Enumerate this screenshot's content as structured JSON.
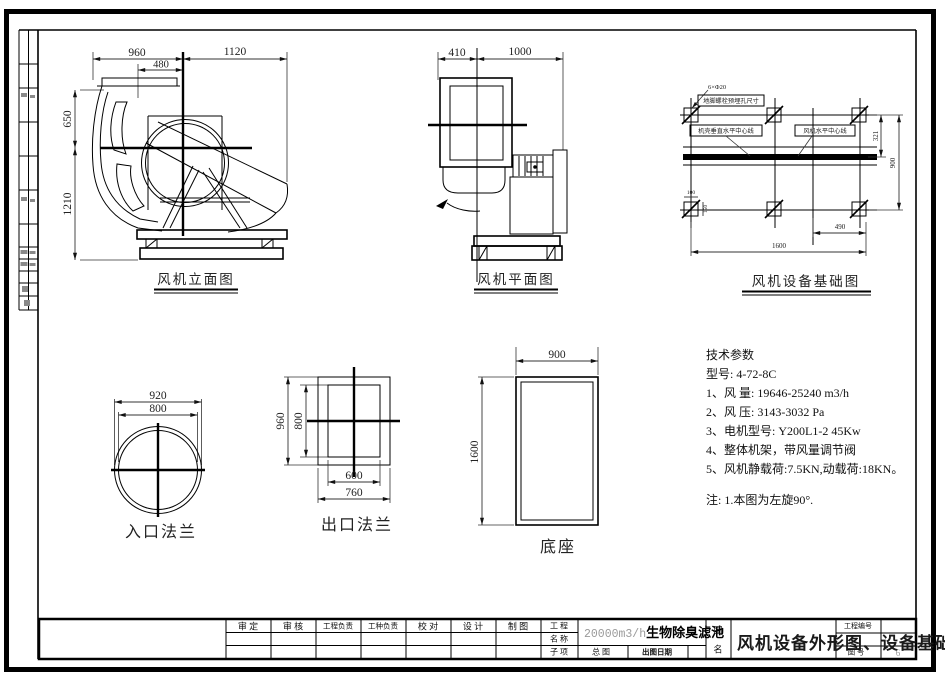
{
  "drawing": {
    "views": {
      "elevation": {
        "label": "风机立面图",
        "dim_960": "960",
        "dim_1120": "1120",
        "dim_480": "480",
        "dim_650": "650",
        "dim_1210": "1210"
      },
      "plan": {
        "label": "风机平面图",
        "dim_410": "410",
        "dim_1000": "1000"
      },
      "foundation": {
        "label": "风机设备基础图",
        "callout_bolts": "6×Φ20",
        "callout_holes": "地脚螺栓预埋孔尺寸",
        "callout_casing_cl": "机壳垂直水平中心线",
        "callout_fan_cl": "风机水平中心线",
        "dim_321": "321",
        "dim_900": "900",
        "dim_490": "490",
        "dim_1600": "1600",
        "dim_100": "100",
        "dim_150": "150"
      },
      "inlet_flange": {
        "label": "入口法兰",
        "dim_920": "920",
        "dim_800": "800"
      },
      "outlet_flange": {
        "label": "出口法兰",
        "dim_960": "960",
        "dim_800": "800",
        "dim_600": "600",
        "dim_760": "760"
      },
      "base": {
        "label": "底座",
        "dim_900": "900",
        "dim_1600": "1600"
      }
    },
    "tech_params": {
      "title": "技术参数",
      "model": "型号: 4-72-8C",
      "items": [
        "1、风    量: 19646-25240 m3/h",
        "2、风    压: 3143-3032 Pa",
        "3、电机型号: Y200L1-2 45Kw",
        "4、整体机架，带风量调节阀",
        "5、风机静载荷:7.5KN,动载荷:18KN。"
      ],
      "note": "注: 1.本图为左旋90°."
    },
    "title_block": {
      "sign_labels": [
        "审  定",
        "审  核",
        "工程负责",
        "工种负责",
        "校  对",
        "设  计",
        "制  图"
      ],
      "project_label_top": "工  程",
      "project_label_bottom": "名  称",
      "subitem_label": "子  项",
      "project_name_prefix": "20000m3/h",
      "project_name": "生物除臭滤池",
      "subitem_value": "总  图",
      "issue_date_label": "出图日期",
      "drawing_name_label_top": "图",
      "drawing_name_label_bottom": "名",
      "drawing_title": "风机设备外形图、设备基础",
      "project_no_label": "工程编号",
      "drawing_no_label": "图  号",
      "drawing_no_value": "6"
    }
  }
}
